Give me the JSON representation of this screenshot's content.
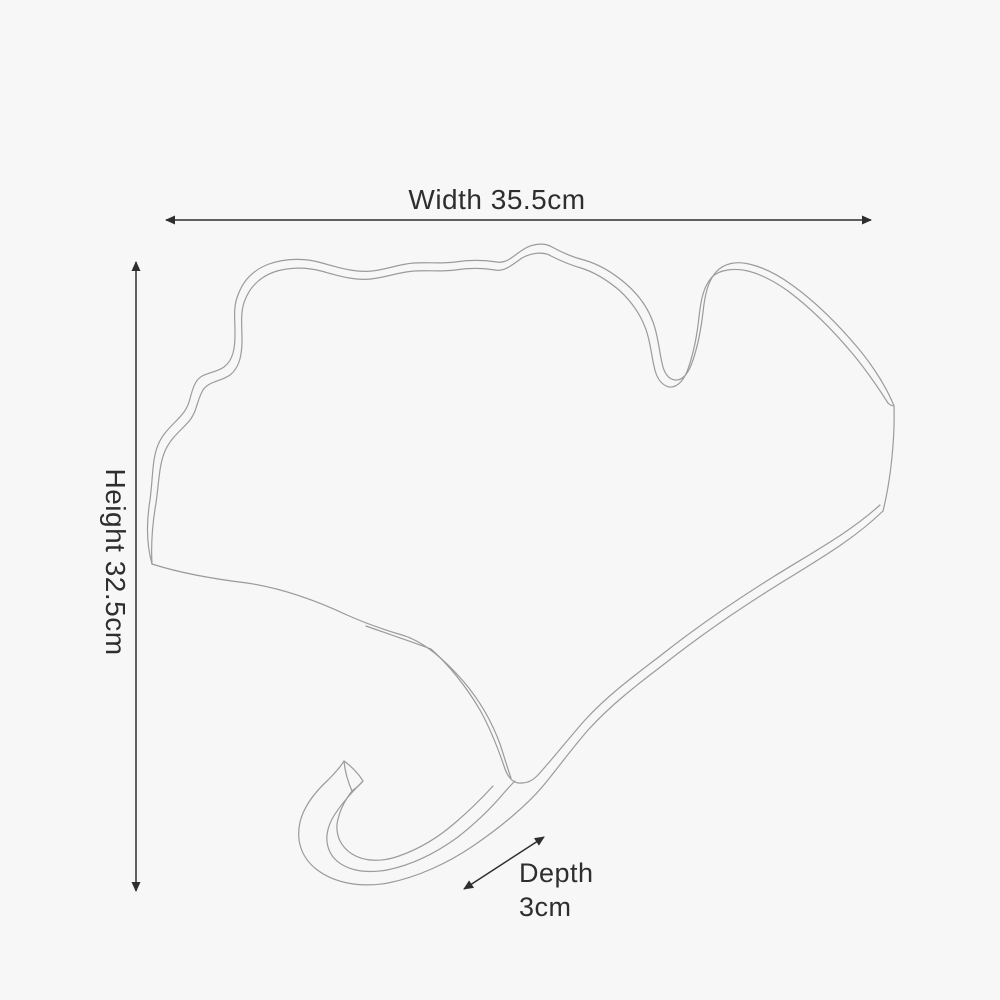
{
  "page": {
    "background_color": "#f7f7f7"
  },
  "diagram": {
    "type": "product-dimension-diagram",
    "object_name": "ginkgo-leaf-wall-hook-outline",
    "line_color": "#9b9b9b",
    "annotation_color": "#2e2e2e",
    "dimensions": {
      "width": {
        "label": "Width 35.5cm",
        "value_cm": 35.5,
        "orientation": "horizontal"
      },
      "height": {
        "label": "Height 32.5cm",
        "value_cm": 32.5,
        "orientation": "vertical"
      },
      "depth": {
        "label_line1": "Depth",
        "label_line2": "3cm",
        "value_cm": 3,
        "orientation": "diagonal"
      }
    }
  }
}
